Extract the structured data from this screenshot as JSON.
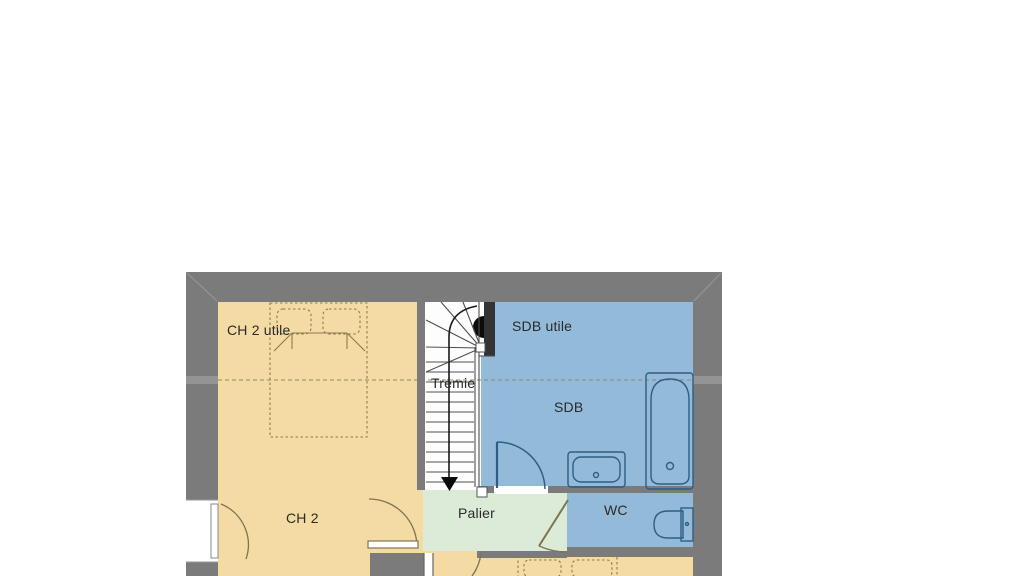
{
  "plan": {
    "type": "floor-plan",
    "rooms": {
      "ch2_utile": {
        "label": "CH 2 utile"
      },
      "tremie": {
        "label": "Trémie"
      },
      "sdb_utile": {
        "label": "SDB utile"
      },
      "sdb": {
        "label": "SDB"
      },
      "ch2": {
        "label": "CH 2"
      },
      "palier": {
        "label": "Palier"
      },
      "wc": {
        "label": "WC"
      }
    }
  },
  "colors": {
    "background": "#ffffff",
    "wall": "#7b7b7b",
    "wall_dark": "#333333",
    "wall_miter": "#989898",
    "wall_notch": "#949494",
    "bedroom_fill": "#f3dba3",
    "bathroom_fill": "#93bbd9",
    "landing_fill": "#dcead8",
    "stairs_fill": "#fdfdfd",
    "stair_stroke": "#4f4f4f",
    "fixture_stroke": "#2f5d85",
    "furniture_stroke": "#8a7a52",
    "door_stroke": "#7d7550",
    "path_stroke": "#1a1a1a",
    "marker_black": "#0b0b0b",
    "text": "#2a2a2a"
  }
}
